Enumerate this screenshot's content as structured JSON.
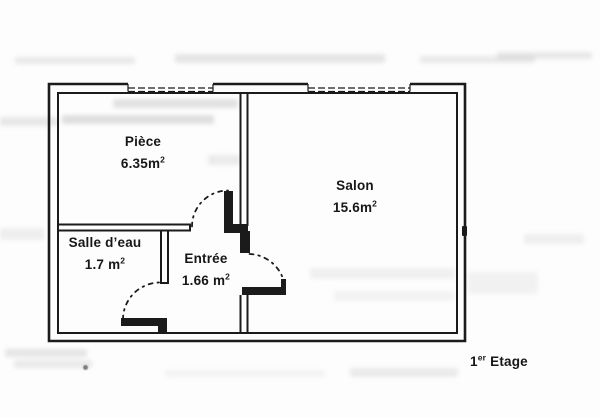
{
  "plan": {
    "rooms": [
      {
        "name": "Pièce",
        "area_value": "6.35m",
        "area_sup": "2"
      },
      {
        "name": "Salon",
        "area_value": "15.6m",
        "area_sup": "2"
      },
      {
        "name": "Salle d’eau",
        "area_value": "1.7 m",
        "area_sup": "2"
      },
      {
        "name": "Entrée",
        "area_value": "1.66 m",
        "area_sup": "2"
      }
    ],
    "floor_label": {
      "number": "1",
      "sup": "er",
      "label": "Etage"
    },
    "colors": {
      "wall": "#1b1b1b",
      "text": "#171717",
      "background": "#fdfdfd",
      "artifact": "#b5b5b5"
    }
  }
}
